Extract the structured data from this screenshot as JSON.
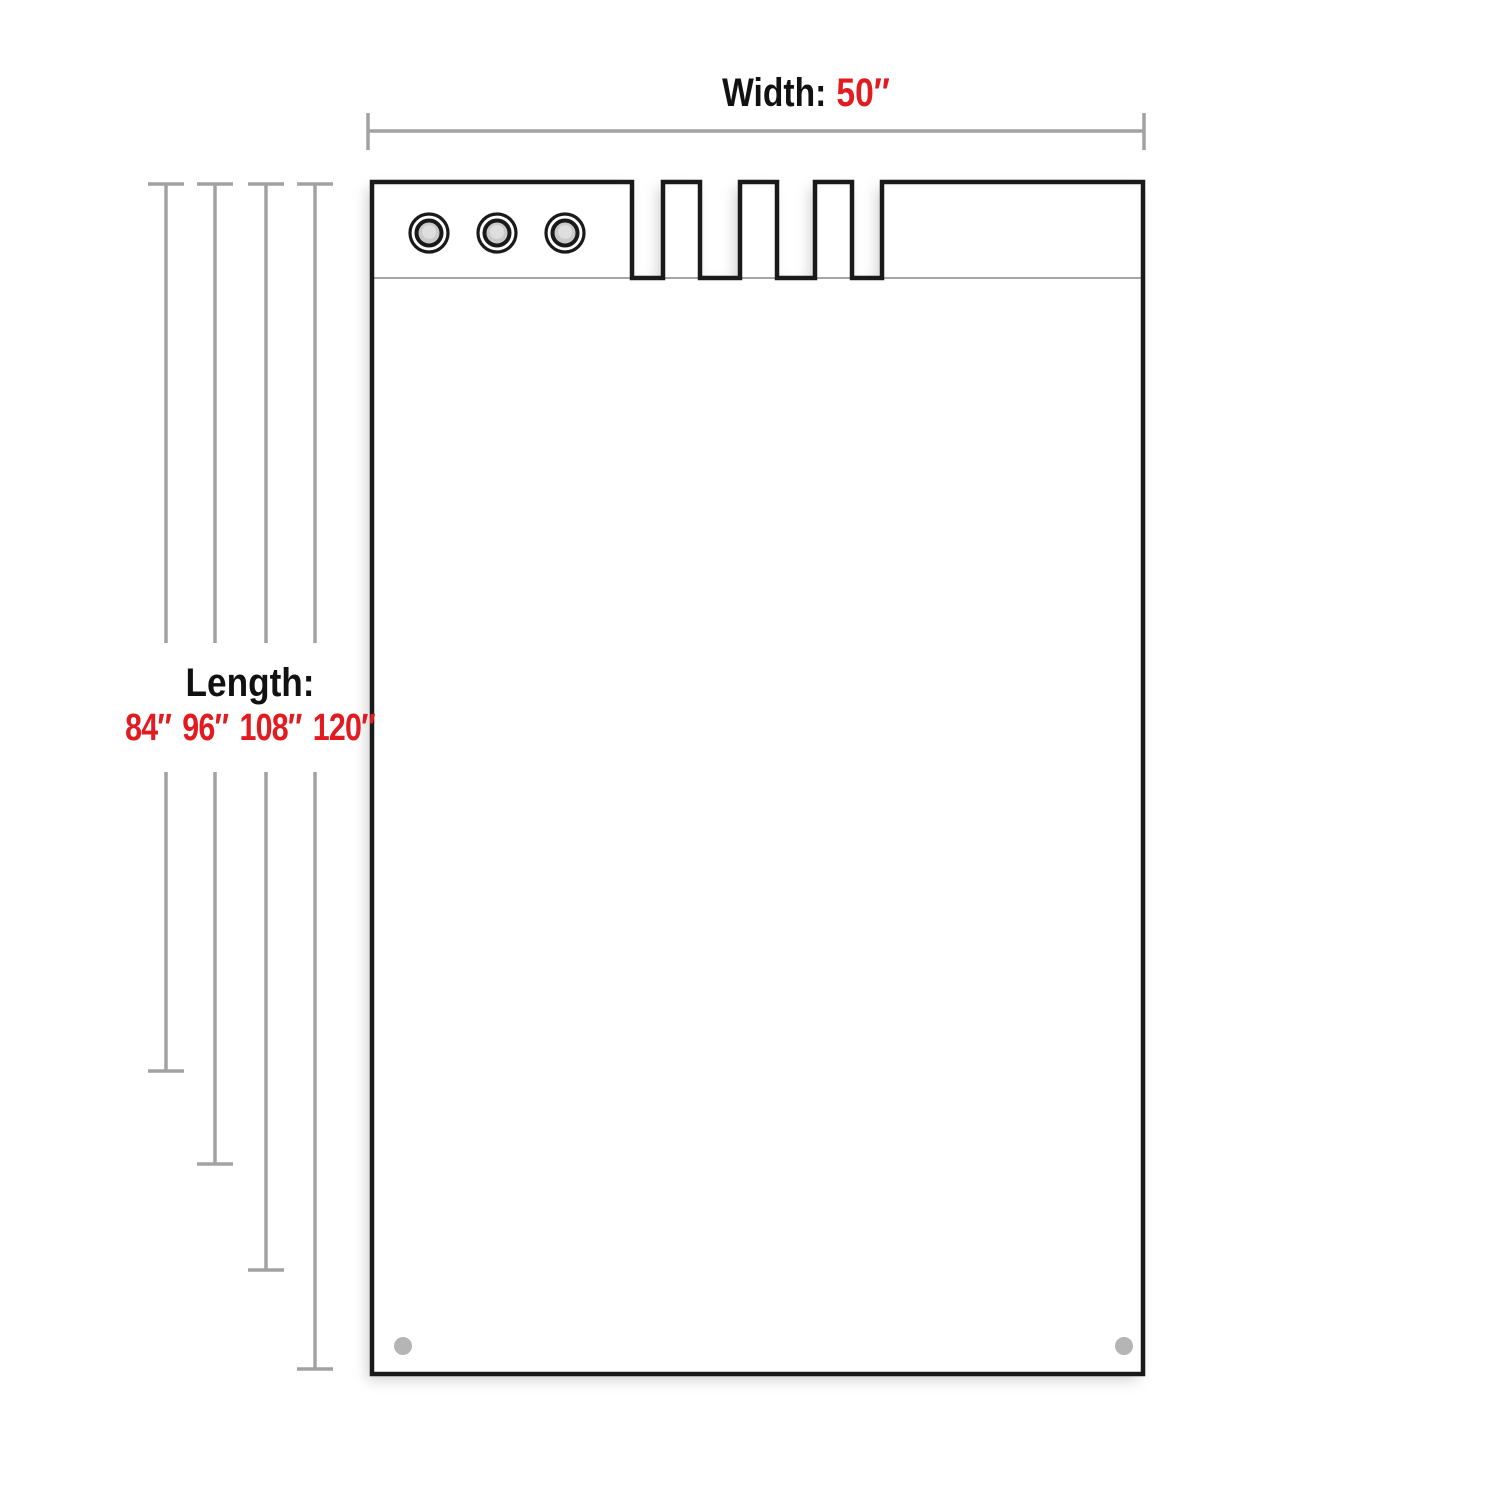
{
  "width_dimension": {
    "label": "Width:",
    "value": "50″"
  },
  "length_dimension": {
    "label": "Length:",
    "values": [
      "84″",
      "96″",
      "108″",
      "120″"
    ]
  },
  "colors": {
    "accent_red": "#e11b20",
    "dimension_line": "#a2a2a2",
    "pad_outline": "#1a1a1a",
    "separator_line": "#9a9a9a",
    "grommet_center": "#c9c9c9",
    "grommet_center_highlight": "#dedede",
    "bottom_hole": "#b5b5b5"
  },
  "diagram": {
    "grommets": 3,
    "bottom_holes": 2,
    "top_notches": 4
  }
}
